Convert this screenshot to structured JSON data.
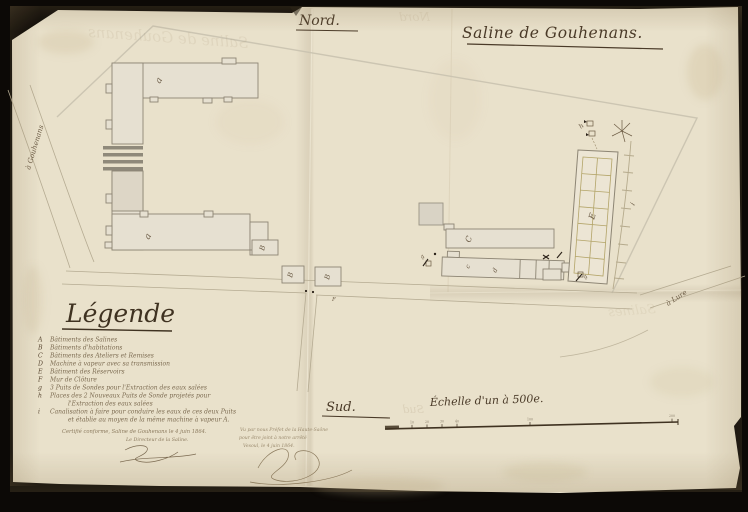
{
  "document": {
    "north_label": "Nord.",
    "south_label": "Sud.",
    "title": "Saline de Gouhenans.",
    "scale_label": "Échelle d'un à 500e.",
    "scale_ticks": [
      {
        "label": "10",
        "x": 412
      },
      {
        "label": "20",
        "x": 427
      },
      {
        "label": "30",
        "x": 442
      },
      {
        "label": "40",
        "x": 457
      },
      {
        "label": "100",
        "x": 530
      },
      {
        "label": "200",
        "x": 672
      }
    ]
  },
  "legend": {
    "title": "Légende",
    "items": [
      {
        "key": "A",
        "text": "Bâtiments des Salines"
      },
      {
        "key": "B",
        "text": "Bâtiments d'habitations"
      },
      {
        "key": "C",
        "text": "Bâtiments des Ateliers et Remises"
      },
      {
        "key": "D",
        "text": "Machine à vapeur avec sa transmission"
      },
      {
        "key": "E",
        "text": "Bâtiment des Réservoirs"
      },
      {
        "key": "F",
        "text": "Mur de Clôture"
      },
      {
        "key": "g",
        "text": "3 Puits de Sondes pour l'Extraction des eaux salées"
      },
      {
        "key": "h",
        "text": "Places des 2 Nouveaux Puits de Sonde projetés pour",
        "text2": "l'Extraction des eaux salées"
      },
      {
        "key": "i",
        "text": "Canalisation à faire pour conduire les eaux de ces deux Puits",
        "text2": "et établie au moyen de la même machine à vapeur A."
      }
    ]
  },
  "annotations": {
    "certification_line1": "Certifié conforme, Saline de Gouhenans le 4 juin 1864.",
    "certification_line2": "Le Directeur de la Saline.",
    "prefect_line1": "Vu par nous Préfet de la Haute-Saône",
    "prefect_line2": "pour être joint à notre arrêté",
    "prefect_line3": "Vesoul, le 4 juin 1864."
  },
  "map_labels": [
    {
      "t": "a",
      "x": 160,
      "y": 84,
      "r": -62,
      "s": 9
    },
    {
      "t": "a",
      "x": 149,
      "y": 240,
      "r": -62,
      "s": 9
    },
    {
      "t": "B",
      "x": 264,
      "y": 251,
      "r": -75,
      "s": 7
    },
    {
      "t": "B",
      "x": 292,
      "y": 278,
      "r": -75,
      "s": 7
    },
    {
      "t": "B",
      "x": 329,
      "y": 280,
      "r": -75,
      "s": 7
    },
    {
      "t": "F",
      "x": 332,
      "y": 301,
      "r": 0,
      "s": 5.5
    },
    {
      "t": "C",
      "x": 470,
      "y": 243,
      "r": -68,
      "s": 8
    },
    {
      "t": "c",
      "x": 469,
      "y": 269,
      "r": -65,
      "s": 6.5
    },
    {
      "t": "d",
      "x": 496,
      "y": 273,
      "r": -65,
      "s": 6.5
    },
    {
      "t": "E",
      "x": 594,
      "y": 220,
      "r": -72,
      "s": 8.5
    },
    {
      "t": "i",
      "x": 634,
      "y": 206,
      "r": -60,
      "s": 7
    },
    {
      "t": "h",
      "x": 581,
      "y": 129,
      "r": -40,
      "s": 6.5
    },
    {
      "t": "g",
      "x": 422,
      "y": 259,
      "r": -45,
      "s": 5.5
    },
    {
      "t": "g",
      "x": 585,
      "y": 279,
      "r": -45,
      "s": 5.5
    },
    {
      "t": "à Gouhenans",
      "x": 30,
      "y": 170,
      "r": -73,
      "s": 7
    },
    {
      "t": "à Lure",
      "x": 668,
      "y": 306,
      "r": -33,
      "s": 7
    }
  ],
  "ghost_texts": [
    {
      "t": "Saline de Gouhenans",
      "x": 248,
      "y": 48,
      "r": 4,
      "s": 15,
      "o": 0.12
    },
    {
      "t": "Nord",
      "x": 430,
      "y": 21,
      "r": 0,
      "s": 12,
      "o": 0.13
    },
    {
      "t": "Sud",
      "x": 424,
      "y": 413,
      "r": 0,
      "s": 11,
      "o": 0.16
    },
    {
      "t": "Salines",
      "x": 656,
      "y": 313,
      "r": -4,
      "s": 13,
      "o": 0.11
    }
  ],
  "colors": {
    "background": "#0c0906",
    "paper": "#e9e1cb",
    "ink": "#4a3a28",
    "legend_ink": "#7b6a50",
    "building_fill": "#e6e0d1",
    "building_stroke": "#8d8574",
    "grid_olive": "#b3a468",
    "faint_boundary": "#c9c2af"
  }
}
